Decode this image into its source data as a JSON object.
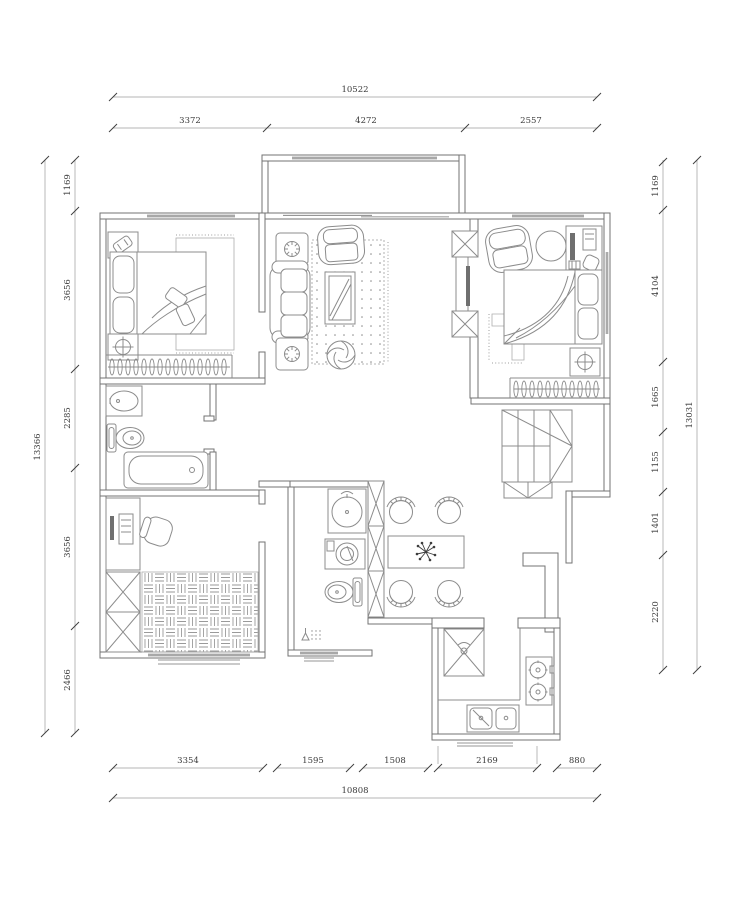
{
  "drawing": {
    "kind": "residential-floor-plan",
    "units": "mm",
    "background": "#ffffff",
    "wall_color": "#737373",
    "furniture_color": "#8c8c8c",
    "dimension_text_color": "#3a3a3a"
  },
  "dims": {
    "top": {
      "overall": "10522",
      "segments": [
        "3372",
        "4272",
        "2557"
      ]
    },
    "bottom": {
      "overall": "10808",
      "segments": [
        "3354",
        "1595",
        "1508",
        "2169",
        "880"
      ]
    },
    "left": {
      "overall": "13366",
      "segments": [
        "1169",
        "3656",
        "2285",
        "3656",
        "2466"
      ]
    },
    "right": {
      "overall": "13031",
      "segments": [
        "1169",
        "4104",
        "1665",
        "1155",
        "1401",
        "2220"
      ]
    }
  },
  "rooms": {
    "bedroom_top_left": [
      "double-bed",
      "pillows",
      "nightstand-phone",
      "nightstand-lamp",
      "bedside-rug",
      "wardrobe-hanger-rail",
      "window"
    ],
    "living_room": [
      "sofa",
      "armchair",
      "side-table-lamp",
      "side-table-lamp",
      "coffee-table",
      "dotted-area-rug",
      "floor-fan",
      "tv",
      "tv-cabinet",
      "balcony-sliding-door"
    ],
    "balcony": [
      "window"
    ],
    "bedroom_top_right": [
      "double-bed",
      "pillows",
      "armchair",
      "round-stool",
      "computer-desk",
      "nightstand-lamp",
      "l-shaped-rug",
      "wardrobe-hanger-rail",
      "window"
    ],
    "bathroom_main": [
      "washbasin",
      "toilet",
      "bathtub"
    ],
    "study": [
      "computer-desk",
      "office-chair",
      "storage-cabinets",
      "parquet-rug",
      "window"
    ],
    "bathroom_small": [
      "washbasin",
      "washing-machine",
      "toilet",
      "floor-drain",
      "window"
    ],
    "dining_area": [
      "dining-table",
      "dining-chairs-x4",
      "centerpiece-plant",
      "partition-columns"
    ],
    "kitchen": [
      "refrigerator",
      "gas-stove-2-burner",
      "double-sink",
      "counter",
      "duct"
    ],
    "stairs": [
      "staircase",
      "landing"
    ]
  }
}
